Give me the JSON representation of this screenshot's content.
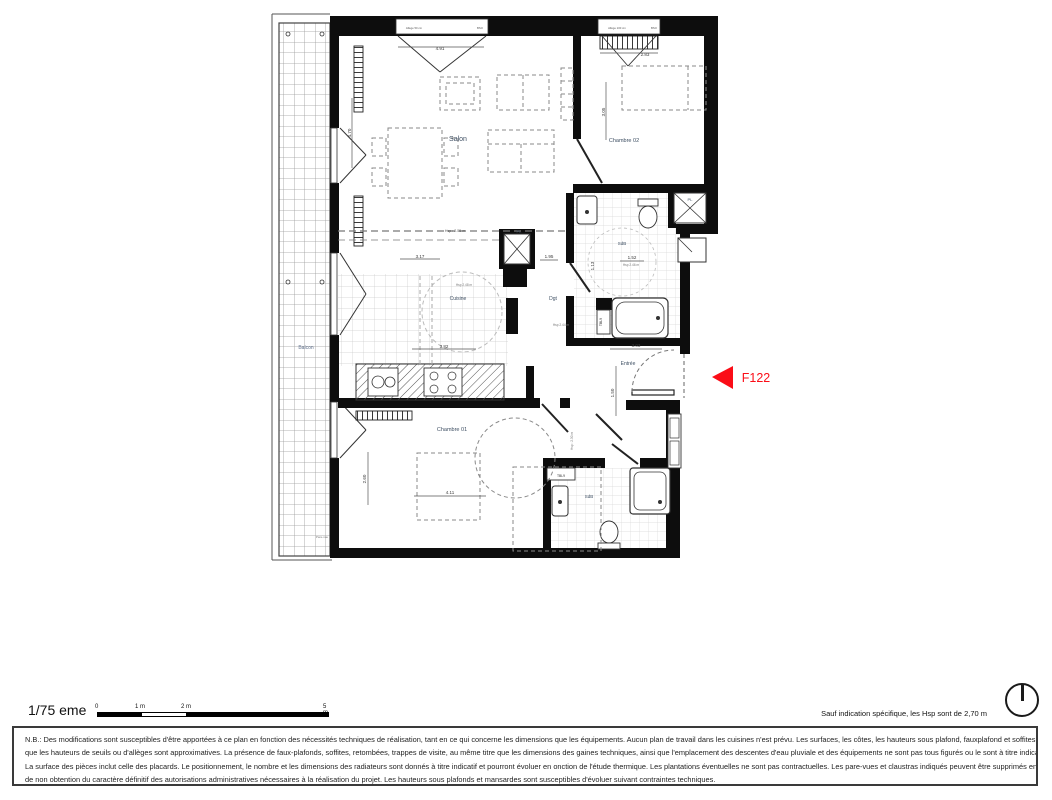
{
  "unit": {
    "label": "F122",
    "color": "#fb0d17"
  },
  "scale": {
    "label": "1/75 eme",
    "ticks": [
      "0",
      "1 m",
      "2 m",
      "5 m"
    ]
  },
  "hsp_note": "Sauf indication spécifique, les Hsp sont de 2,70 m",
  "disclaimer": {
    "lines": [
      "N.B.: Des modifications sont susceptibles d'être apportées à ce plan en fonction des nécessités techniques de réalisation, tant en ce qui concerne les dimensions que les équipements. Aucun plan de travail dans les cuisines n'est prévu. Les surfaces, les côtes, les hauteurs sous plafond, fauxplafond et soffites, ainsi",
      "que les hauteurs de seuils ou d'allèges sont approximatives. La présence de faux-plafonds, soffites, retombées, trappes de visite, au même titre que les dimensions des gaines techniques, ainsi que l'emplacement des descentes d'eau pluviale et des équipements ne sont pas tous figurés ou le sont à titre indicatif.",
      "La surface des pièces inclut celle des placards. Le positionnement, le nombre et les dimensions des radiateurs sont donnés à titre indicatif et pourront évoluer en onction de l'étude thermique. Les plantations éventuelles ne sont pas contractuelles. Les pare-vues et claustras indiqués peuvent être supprimés en cas",
      "de non obtention du caractère définitif des autorisations administratives nécessaires à la réalisation du projet. Les hauteurs sous plafonds et mansardes sont susceptibles d'évoluer suivant contraintes techniques."
    ]
  },
  "plan": {
    "label_color": "#3e4f63",
    "dim_color": "#3a3a3a",
    "labels": [
      {
        "text": "Salon",
        "x": 458,
        "y": 141,
        "size": 7,
        "name": "room-label-salon"
      },
      {
        "text": "Chambre 02",
        "x": 624,
        "y": 142,
        "size": 5.5,
        "name": "room-label-chambre-02"
      },
      {
        "text": "Cuisine",
        "x": 458,
        "y": 300,
        "size": 5,
        "name": "room-label-cuisine"
      },
      {
        "text": "Dgt",
        "x": 553,
        "y": 300,
        "size": 5,
        "name": "room-label-dgt"
      },
      {
        "text": "Entrée",
        "x": 628,
        "y": 365,
        "size": 5,
        "name": "room-label-entree"
      },
      {
        "text": "Chambre 01",
        "x": 452,
        "y": 431,
        "size": 5.5,
        "name": "room-label-chambre-01"
      },
      {
        "text": "SdB",
        "x": 622,
        "y": 245,
        "size": 4.5,
        "name": "room-label-sdb-1"
      },
      {
        "text": "SdB",
        "x": 589,
        "y": 498,
        "size": 4.5,
        "name": "room-label-sdb-2"
      },
      {
        "text": "Balcon",
        "x": 306,
        "y": 349,
        "size": 5,
        "color": "#5f6f8a",
        "name": "room-label-balcon"
      },
      {
        "text": "PL",
        "x": 690,
        "y": 201,
        "size": 4,
        "name": "closet-label-pl-1"
      },
      {
        "text": "PL",
        "x": 519,
        "y": 233,
        "size": 4,
        "name": "closet-label-pl-2"
      },
      {
        "text": "4.91",
        "x": 440,
        "y": 50,
        "size": 4.5,
        "color": "#3a3a3a",
        "name": "dim-salon-width"
      },
      {
        "text": "2.83",
        "x": 645,
        "y": 56,
        "size": 4.5,
        "color": "#3a3a3a",
        "name": "dim-chambre02-width"
      },
      {
        "text": "3.05",
        "x": 605,
        "y": 112,
        "size": 4.5,
        "rot": -90,
        "color": "#3a3a3a",
        "name": "dim-chambre02-depth"
      },
      {
        "text": "4.70",
        "x": 351,
        "y": 133,
        "size": 4.5,
        "rot": -90,
        "color": "#3a3a3a",
        "name": "dim-salon-depth"
      },
      {
        "text": "3.17",
        "x": 420,
        "y": 258,
        "size": 4.5,
        "color": "#3a3a3a",
        "name": "dim-cuisine-1"
      },
      {
        "text": "3.82",
        "x": 444,
        "y": 348,
        "size": 4.5,
        "color": "#3a3a3a",
        "name": "dim-cuisine-2"
      },
      {
        "text": "1.95",
        "x": 549,
        "y": 258,
        "size": 4.5,
        "color": "#3a3a3a",
        "name": "dim-dgt"
      },
      {
        "text": "1.52",
        "x": 632,
        "y": 259,
        "size": 4.5,
        "color": "#3a3a3a",
        "name": "dim-sdb1"
      },
      {
        "text": "1.13",
        "x": 594,
        "y": 266,
        "size": 4.5,
        "rot": -90,
        "color": "#3a3a3a",
        "name": "dim-sdb1-v"
      },
      {
        "text": "3.03",
        "x": 636,
        "y": 347,
        "size": 4.5,
        "color": "#3a3a3a",
        "name": "dim-entree-w"
      },
      {
        "text": "1.50",
        "x": 614,
        "y": 393,
        "size": 4.5,
        "rot": -90,
        "color": "#3a3a3a",
        "name": "dim-entree-h"
      },
      {
        "text": "4.11",
        "x": 450,
        "y": 494,
        "size": 4.5,
        "color": "#3a3a3a",
        "name": "dim-chambre01-w"
      },
      {
        "text": "2.60",
        "x": 366,
        "y": 479,
        "size": 4.5,
        "rot": -90,
        "color": "#3a3a3a",
        "name": "dim-chambre01-h"
      },
      {
        "text": "Hsp : 2.55 m",
        "x": 455,
        "y": 232,
        "size": 3.6,
        "color": "#555",
        "name": "note-hsp-salon"
      },
      {
        "text": "Hsp 2.48 m",
        "x": 464,
        "y": 286,
        "size": 3.2,
        "color": "#777",
        "name": "note-hsp-cuisine"
      },
      {
        "text": "Hsp 2.44 m",
        "x": 561,
        "y": 326,
        "size": 3.2,
        "color": "#777",
        "name": "note-hsp-dgt"
      },
      {
        "text": "Hsp 2.46 m",
        "x": 631,
        "y": 266,
        "size": 3.2,
        "color": "#777",
        "name": "note-hsp-sdb1"
      },
      {
        "text": "Hsp : 2.30 m",
        "x": 573,
        "y": 441,
        "size": 3.2,
        "rot": -90,
        "color": "#777",
        "name": "note-hsp-chambre01"
      },
      {
        "text": "TBL9",
        "x": 602,
        "y": 322,
        "size": 3.4,
        "rot": -90,
        "color": "#333",
        "name": "label-tbl9-1"
      },
      {
        "text": "TBL9",
        "x": 561,
        "y": 477,
        "size": 3.4,
        "color": "#333",
        "name": "label-tbl9-2"
      },
      {
        "text": "Allège 50 cm",
        "x": 414,
        "y": 29,
        "size": 2.8,
        "color": "#555",
        "name": "note-allege-salon"
      },
      {
        "text": "BSO",
        "x": 480,
        "y": 29,
        "size": 2.8,
        "color": "#555",
        "name": "note-bso-salon"
      },
      {
        "text": "Allège 100 cm",
        "x": 617,
        "y": 29,
        "size": 2.8,
        "color": "#555",
        "name": "note-allege-chambre02"
      },
      {
        "text": "BSO",
        "x": 654,
        "y": 29,
        "size": 2.8,
        "color": "#555",
        "name": "note-bso-chambre02"
      },
      {
        "text": "Pare-vue",
        "x": 322,
        "y": 538,
        "size": 3,
        "color": "#777",
        "name": "note-pare-vue"
      },
      {
        "text": "F122",
        "x": 756,
        "y": 382,
        "size": 12.5,
        "color": "#fb0d17",
        "name": "unit-id-label"
      }
    ]
  }
}
